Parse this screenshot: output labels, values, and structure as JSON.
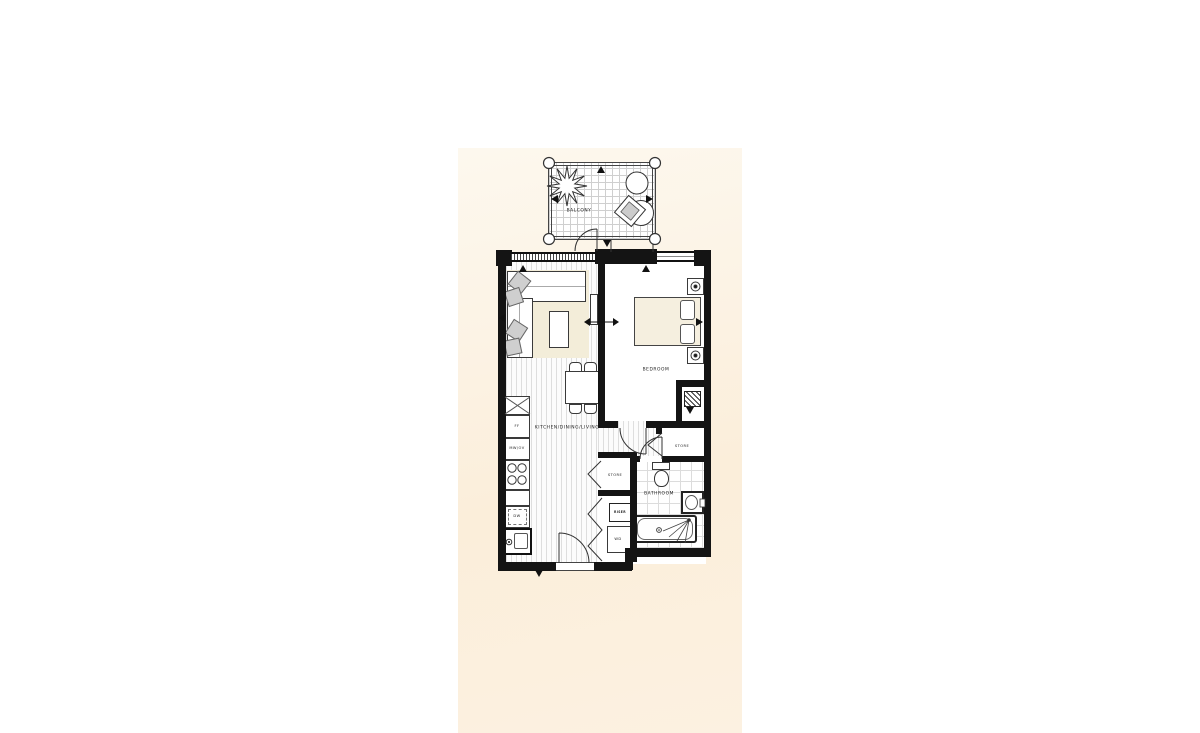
{
  "plan": {
    "rooms": {
      "balcony": {
        "label": "BALCONY"
      },
      "bedroom": {
        "label": "BEDROOM"
      },
      "kitchen_dining_living": {
        "label": "KITCHEN/DINING/LIVING"
      },
      "bathroom": {
        "label": "BATHROOM"
      },
      "store_upper": {
        "label": "STORE"
      },
      "store_lower": {
        "label": "STORE"
      }
    },
    "fixtures": {
      "fridge_freezer": {
        "label": "FF"
      },
      "microwave_oven": {
        "label": "MW/OV"
      },
      "dishwasher": {
        "label": "DW"
      },
      "riser_cupboard": {
        "label": "RISER"
      },
      "washer_dryer": {
        "label": "WD"
      }
    },
    "colors": {
      "page_background": "#ffffff",
      "backdrop_cream": "#fbefdc",
      "wall_black": "#141414",
      "furniture_beige": "#f3edd9",
      "drawing_line": "#333333"
    }
  }
}
